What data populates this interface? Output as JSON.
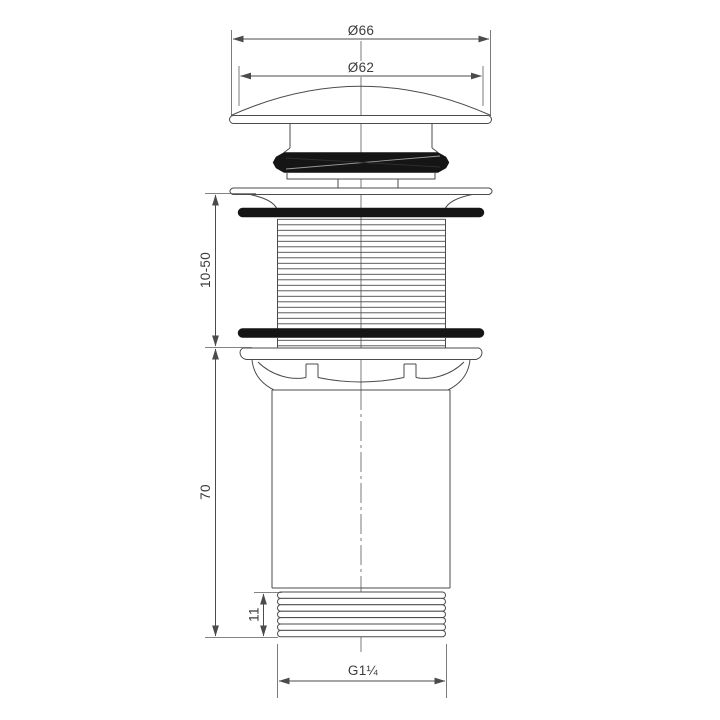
{
  "drawing": {
    "subject": "click-clack-basin-waste-dimensioned-elevation",
    "background": "#ffffff",
    "line_color": "#4b4b4b",
    "gasket_color": "#151515",
    "dimensions": {
      "cap_outer_diameter": "Ø66",
      "cap_dome_diameter": "Ø62",
      "clamping_range": "10-50",
      "body_length": "70",
      "bottom_thread_length": "11",
      "connection_thread": "G1¼"
    }
  }
}
